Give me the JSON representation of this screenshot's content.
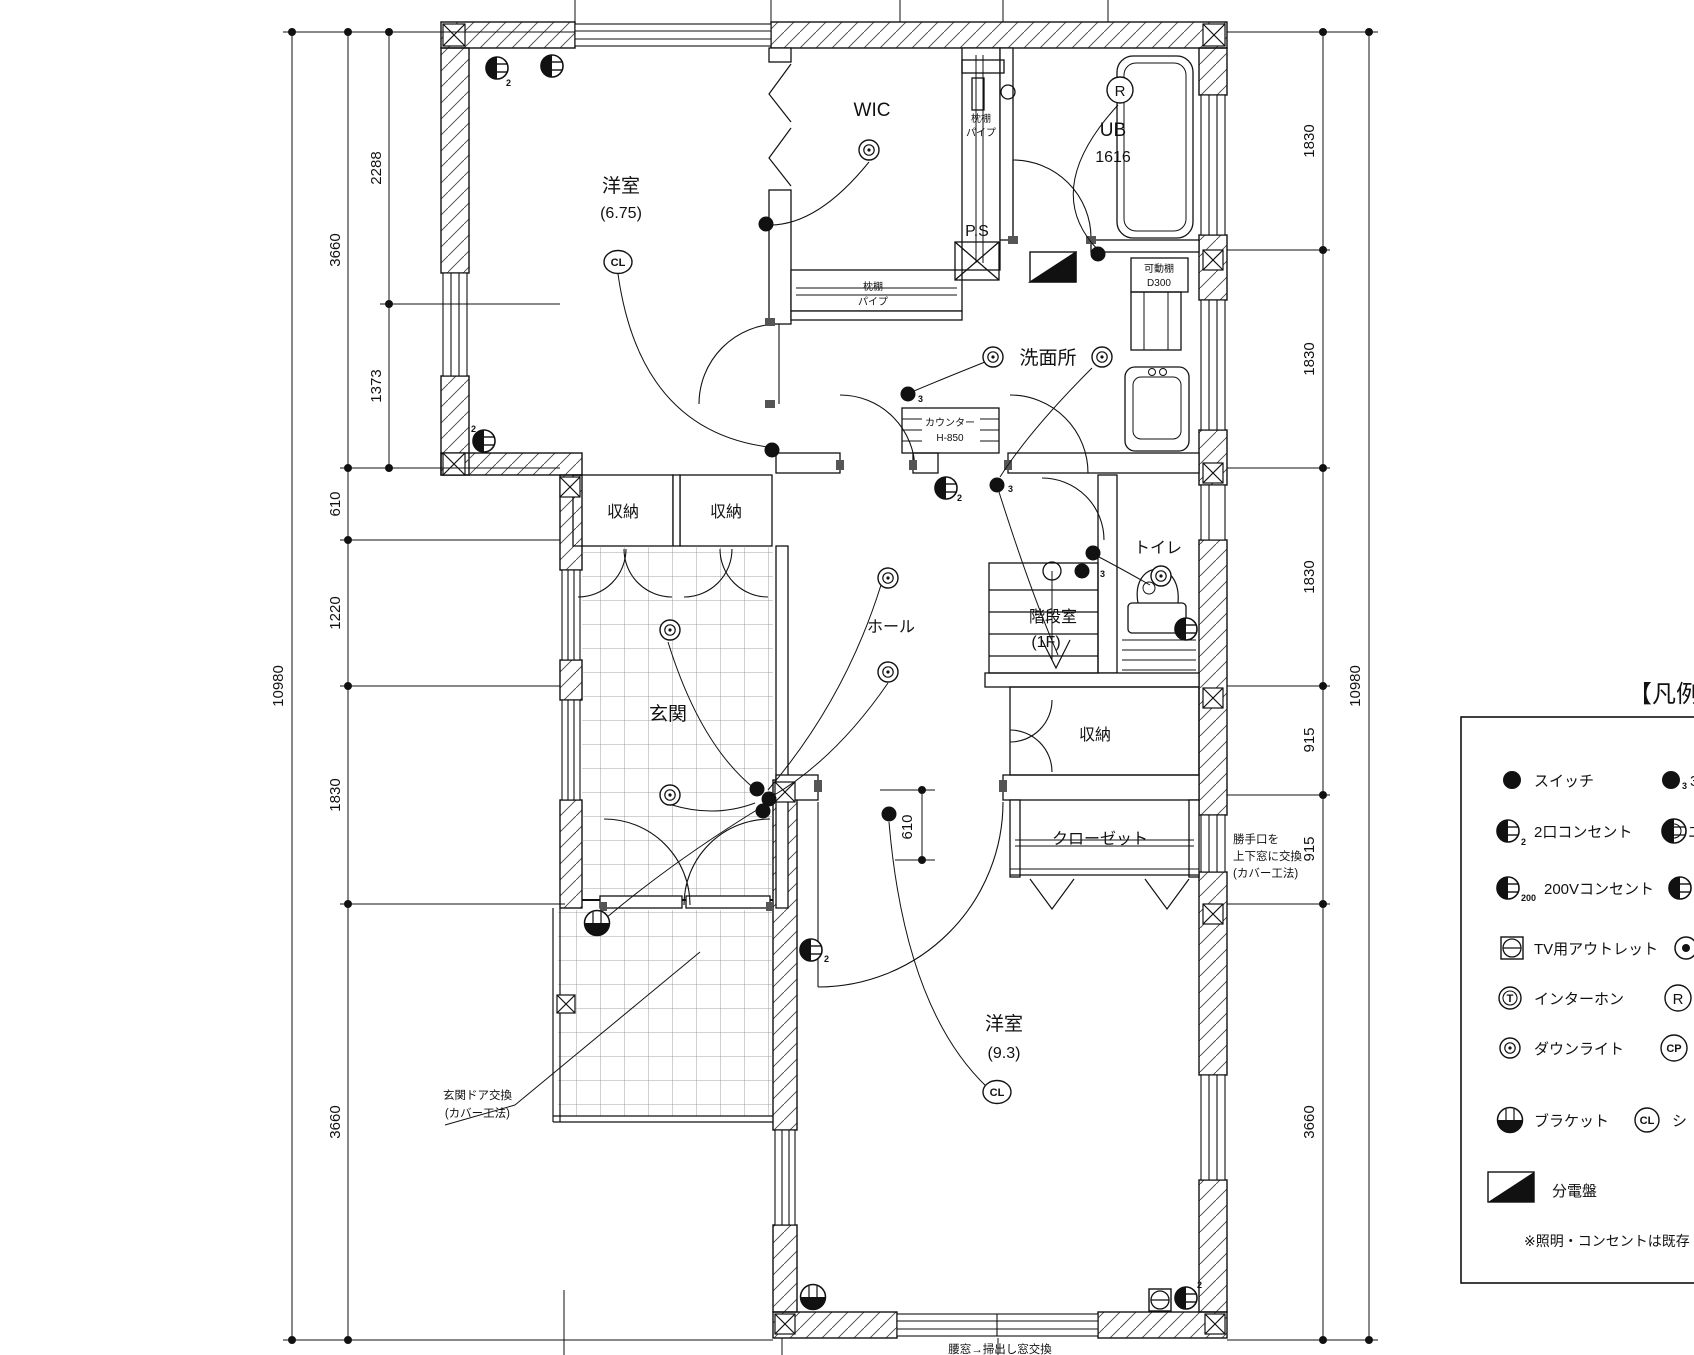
{
  "rooms": {
    "youshitsu_675": {
      "name": "洋室",
      "area": "(6.75)"
    },
    "wic": {
      "name": "WIC"
    },
    "ub": {
      "name": "UB",
      "size": "1616"
    },
    "ps": {
      "name": "P.S"
    },
    "senmenjo": {
      "name": "洗面所"
    },
    "shuunou_a": {
      "name": "収納"
    },
    "shuunou_b": {
      "name": "収納"
    },
    "genkan": {
      "name": "玄関"
    },
    "hall": {
      "name": "ホール"
    },
    "kaidan": {
      "name": "階段室",
      "floor": "(1F)"
    },
    "toire": {
      "name": "トイレ"
    },
    "shuunou_c": {
      "name": "収納"
    },
    "closet": {
      "name": "クローゼット"
    },
    "youshitsu_93": {
      "name": "洋室",
      "area": "(9.3)"
    }
  },
  "fixtures": {
    "makura_side": {
      "line1": "枕棚",
      "line2": "パイプ"
    },
    "makura_bottom": {
      "line1": "枕棚",
      "line2": "パイプ"
    },
    "counter": {
      "line1": "カウンター",
      "line2": "H-850"
    },
    "kadou_dana": {
      "line1": "可動棚",
      "line2": "D300"
    }
  },
  "symbols": {
    "cl": "CL",
    "r": "R",
    "t": "T",
    "cp": "CP",
    "sub2": "2",
    "sub3": "3",
    "sub200": "200"
  },
  "annotations": {
    "genkan_door": {
      "line1": "玄関ドア交換",
      "line2": "(カバー工法)"
    },
    "katteguchi": {
      "line1": "勝手口を",
      "line2": "上下窓に交換",
      "line3": "(カバー工法)"
    },
    "koshimado": {
      "text": "腰窓→掃出し窓交換"
    }
  },
  "dimensions": {
    "left_overall": "10980",
    "left_chain": [
      "3660",
      "610",
      "1220",
      "1830",
      "3660"
    ],
    "left_sub": [
      "2288",
      "1373"
    ],
    "right_overall": "10980",
    "right_chain": [
      "1830",
      "1830",
      "1830",
      "915",
      "915",
      "3660"
    ],
    "mid_610": "610"
  },
  "legend": {
    "title": "【凡例】",
    "rows": [
      {
        "label": "スイッチ"
      },
      {
        "label": "2口コンセント"
      },
      {
        "label": "200Vコンセント"
      },
      {
        "label": "TV用アウトレット"
      },
      {
        "label": "インターホン"
      },
      {
        "label": "ダウンライト"
      },
      {
        "label": "ブラケット"
      },
      {
        "label": "分電盤"
      }
    ],
    "right_col": {
      "r1": "3",
      "r2": "エ",
      "r5": "R",
      "r6": "CP",
      "r7_sym": "CL",
      "r7": "シ"
    },
    "note": "※照明・コンセントは既存"
  }
}
